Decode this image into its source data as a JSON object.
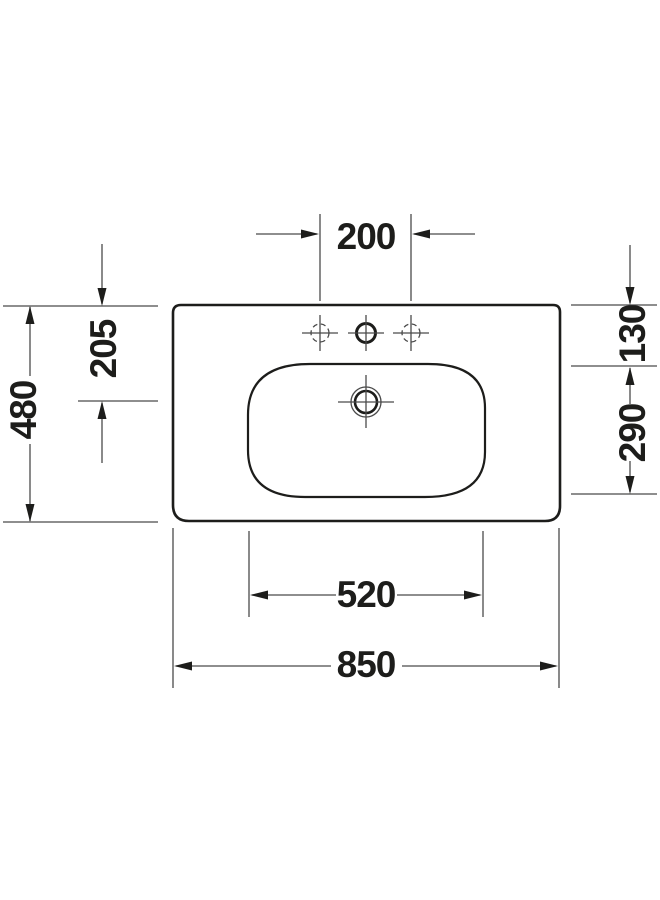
{
  "title": "Washbasin technical drawing - top view",
  "colors": {
    "background": "#ffffff",
    "outline": "#1d1d1b",
    "dimension_lines": "#4a4a4a",
    "text": "#1d1d1b"
  },
  "symbols": {
    "drain": "concentric-circles-with-crosshair",
    "tap_hole_center": "solid-circle-with-crosshair",
    "tap_hole_side": "dashed-circle-with-crosshair"
  },
  "dims": {
    "tap_hole_spacing": "200",
    "front_to_drain": "205",
    "depth": "480",
    "edge_to_basin": "130",
    "basin_depth": "290",
    "basin_width": "520",
    "width": "850"
  }
}
